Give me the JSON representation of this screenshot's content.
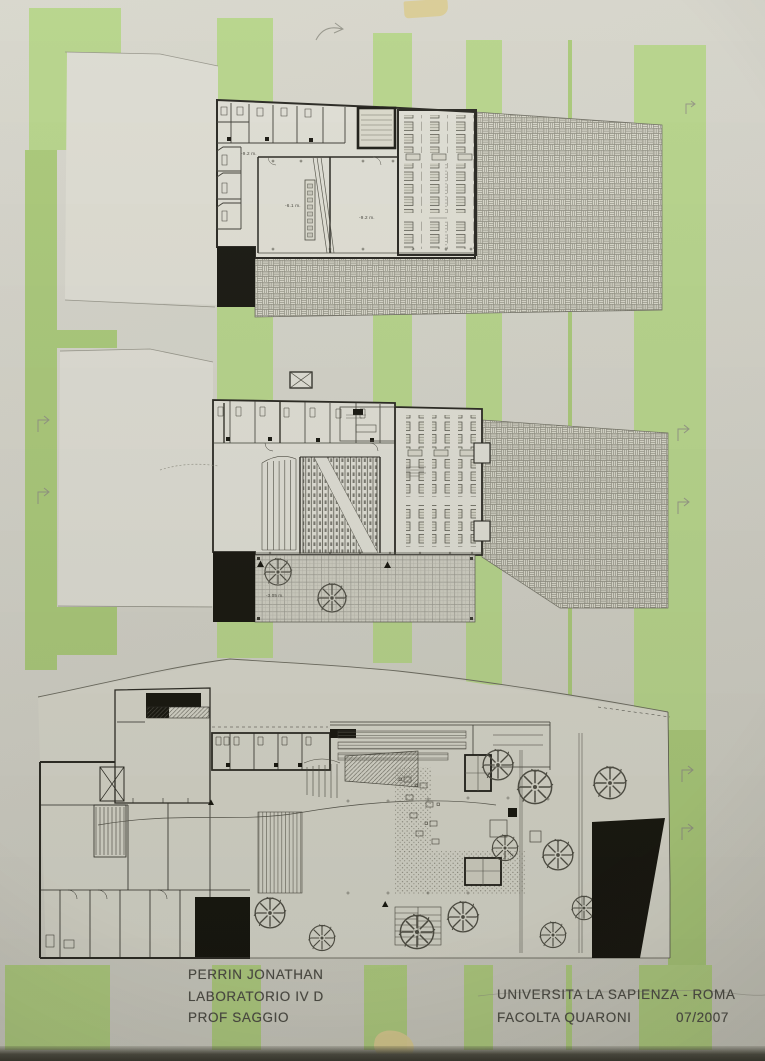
{
  "photo_colors": {
    "board_background": "#d2d1c7",
    "stripe_green": "#aecd7e",
    "paper_white": "#dfded4",
    "drawing_ink": "#3c3b33",
    "black_fill": "#16150e",
    "tape_yellow": "#d9ca8f"
  },
  "title_block": {
    "author_lines": [
      "PERRIN JONATHAN",
      "LABORATORIO IV D",
      "PROF SAGGIO"
    ],
    "university_line": "UNIVERSITA LA SAPIENZA - ROMA",
    "faculty_line": "FACOLTA QUARONI",
    "date": "07/2007"
  },
  "plans": {
    "upper_level": {
      "labels": {
        "corridor_level": "-9.2 m.",
        "stage_level": "-6.1 m.",
        "hall_level": "-9.2 m."
      }
    },
    "intermediate_level": {
      "labels": {
        "courtyard_level": "-3.05 m."
      }
    },
    "ground_level": {
      "labels": {}
    }
  }
}
